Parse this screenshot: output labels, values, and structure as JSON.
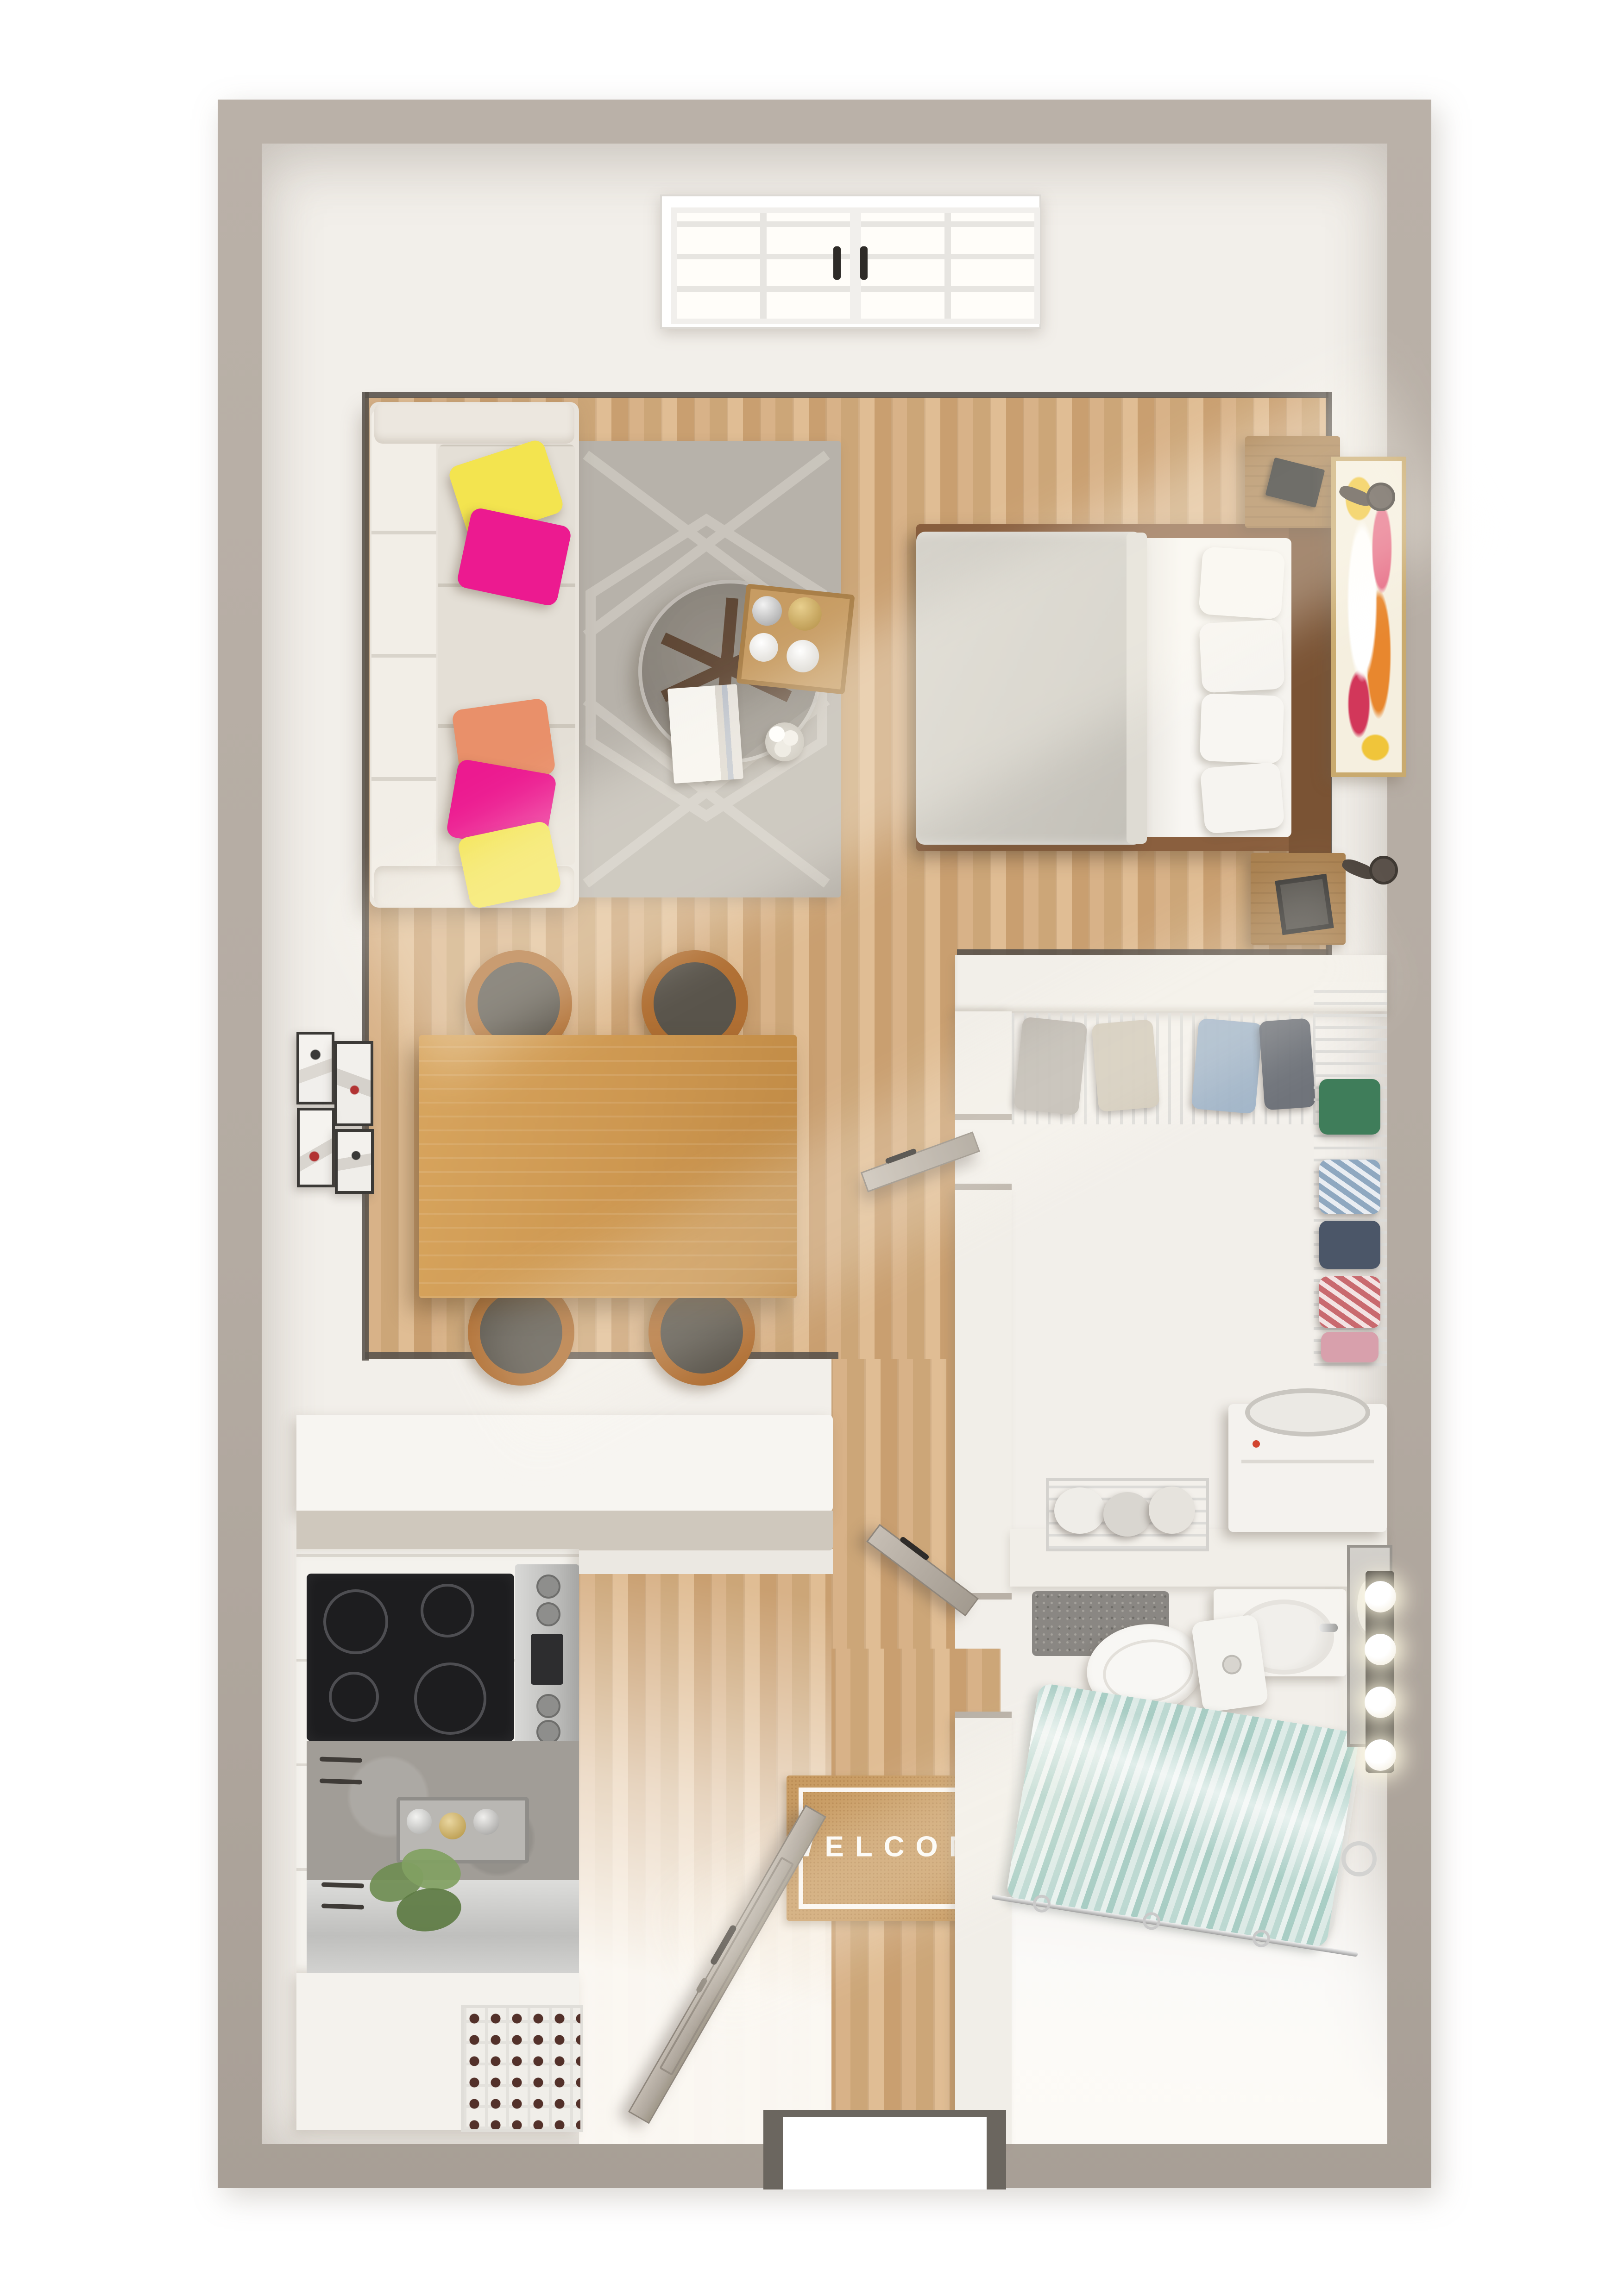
{
  "scene": {
    "kind": "3d-top-down-floor-plan-render",
    "subject": "studio apartment"
  },
  "entry": {
    "welcome_mat": {
      "text": "WELCOME"
    },
    "front_door": {
      "state": "open"
    }
  },
  "window": {
    "sashes": 2,
    "panes_per_sash": 6,
    "handle_color": "#2e2b28"
  },
  "bathroom": {
    "vanity_light_count": 4,
    "fixtures": [
      "vanity-sink",
      "mirror",
      "toilet",
      "bathtub",
      "shower-curtain",
      "bath-mat",
      "towel-ring"
    ]
  },
  "closet": {
    "fixtures": [
      "wire-shelf-top",
      "wire-shelf-right",
      "hanging-clothes",
      "laundry-basket",
      "washer"
    ]
  },
  "kitchen": {
    "fixtures": [
      "peninsula-counter",
      "cooktop",
      "oven-range",
      "backsplash-counter",
      "spice-tray",
      "plant",
      "stainless-counter",
      "wine-rack"
    ]
  },
  "living": {
    "fixtures": [
      "sofa",
      "area-rug",
      "round-coffee-table",
      "wood-tray",
      "books",
      "vase"
    ],
    "pillow_colors": [
      "#f3e44f",
      "#ec1a90",
      "#e9906a",
      "#ec1a90",
      "#f3e44f"
    ]
  },
  "sleeping": {
    "fixtures": [
      "double-bed",
      "gray-blanket",
      "white-pillows",
      "nightstand",
      "nightstand",
      "wall-lamp",
      "wall-lamp",
      "abstract-painting"
    ]
  },
  "dining": {
    "fixtures": [
      "wood-table",
      "four-chairs",
      "gallery-wall-4-frames"
    ]
  },
  "palette": {
    "background": "#ffffff",
    "outer_wall": "#b4aba2",
    "interior_wall": "#f2efea",
    "floor_oak": "#d2ab7f",
    "floor_walnut": "#8f6849",
    "trim_dark": "#57514a",
    "rug_gray": "#b7b2aa",
    "sofa_beige": "#e8e3db",
    "pillow_yellow": "#f3e44f",
    "pillow_magenta": "#ec1a90",
    "pillow_orange": "#e9906a",
    "blanket_gray": "#d0cdc5",
    "bed_wood": "#8a5f3e",
    "dining_wood": "#cf9a55",
    "chair_wood": "#b06f33",
    "counter_white": "#f6f4f0",
    "cooktop_black": "#1d1d1f",
    "stainless": "#c9c9c7",
    "concrete": "#a19d97",
    "curtain_teal": "#a8cfc6",
    "door_greige": "#b2aaa0",
    "mat_tan": "#c89b62",
    "painting_gold_frame": "#c9aa6e"
  }
}
